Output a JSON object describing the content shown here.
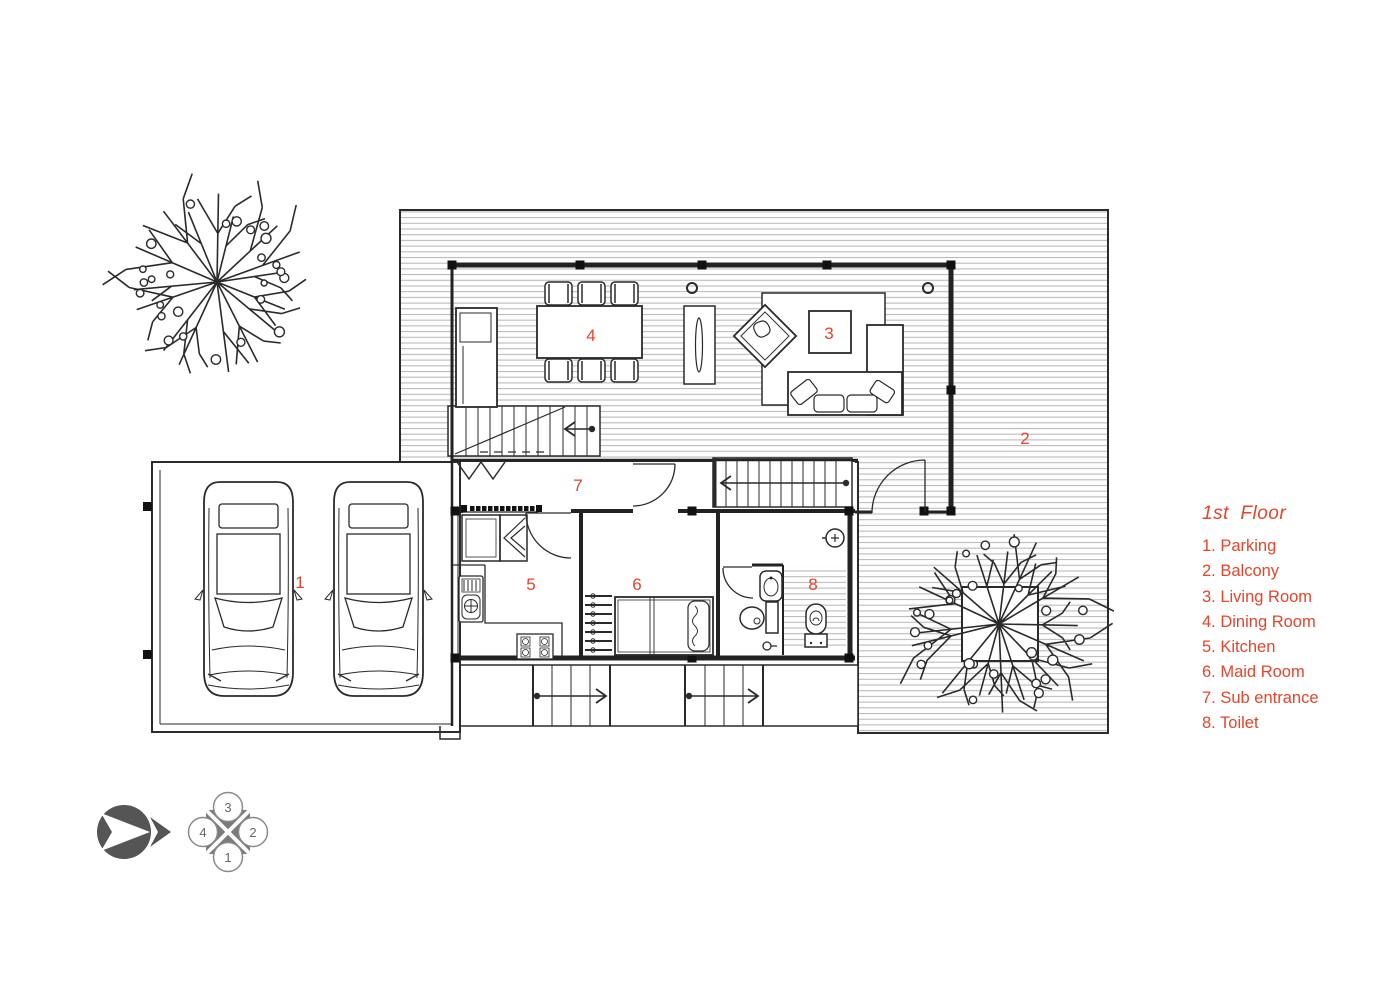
{
  "colors": {
    "accent": "#e8432b",
    "line": "#2a2a2a",
    "hatch": "#b9b9b9",
    "compass": "#555555"
  },
  "legend": {
    "title": "1st  Floor",
    "items": [
      "1. Parking",
      "2. Balcony",
      "3. Living Room",
      "4. Dining Room",
      "5. Kitchen",
      "6. Maid Room",
      "7. Sub entrance",
      "8. Toilet"
    ]
  },
  "plan": {
    "markers": [
      {
        "room": "parking",
        "number": "1"
      },
      {
        "room": "balcony",
        "number": "2"
      },
      {
        "room": "living-room",
        "number": "3"
      },
      {
        "room": "dining-room",
        "number": "4"
      },
      {
        "room": "kitchen",
        "number": "5"
      },
      {
        "room": "maid-room",
        "number": "6"
      },
      {
        "room": "sub-entrance",
        "number": "7"
      },
      {
        "room": "toilet",
        "number": "8"
      }
    ]
  },
  "compass": {
    "top": "3",
    "right": "2",
    "bottom": "1",
    "left": "4"
  }
}
